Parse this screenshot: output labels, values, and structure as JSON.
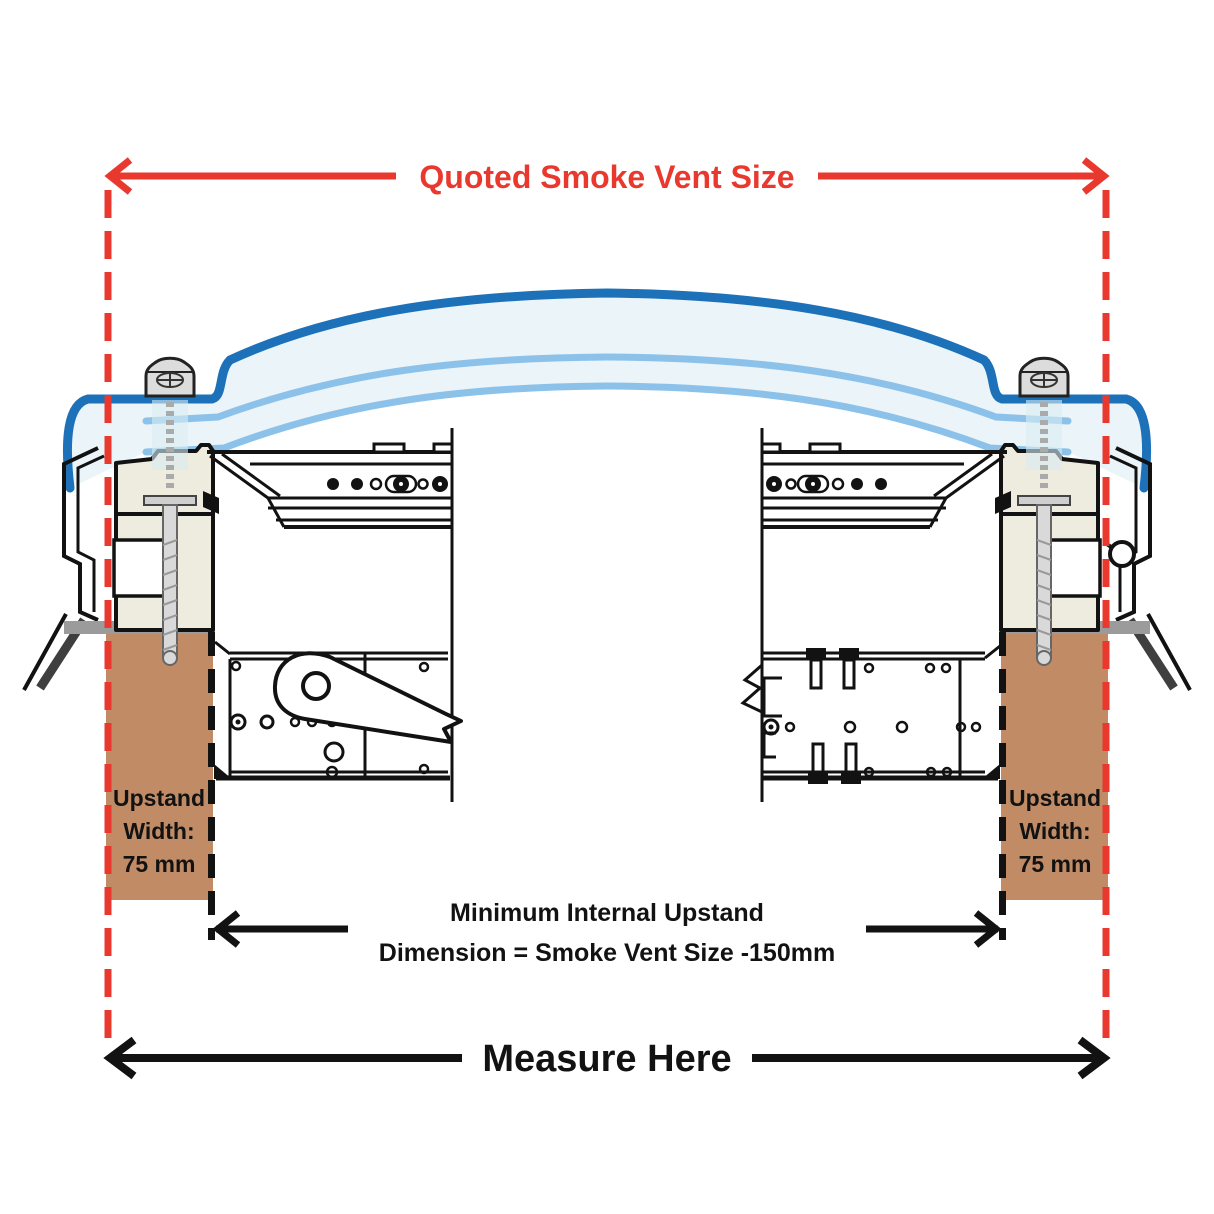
{
  "diagram": {
    "title": "Smoke vent upstand measurement cross-section",
    "annotations": {
      "top_dimension": {
        "label": "Quoted Smoke Vent Size"
      },
      "internal_dimension": {
        "line1": "Minimum Internal Upstand",
        "line2": "Dimension = Smoke Vent Size -150mm"
      },
      "upstand_left": {
        "line1": "Upstand",
        "line2": "Width:",
        "line3": "75 mm"
      },
      "upstand_right": {
        "line1": "Upstand",
        "line2": "Width:",
        "line3": "75 mm"
      },
      "bottom_dimension": {
        "label": "Measure Here"
      }
    }
  },
  "colors": {
    "dimension_red": "#e9392f",
    "line_black": "#121212",
    "dome_outer_blue": "#1d71b8",
    "dome_inner_blue": "#8cc2ea",
    "dome_fill": "#eaf4f9",
    "frame_cream": "#edecdf",
    "upstand_brown": "#c08b65",
    "capping_grey": "#9b9b9b",
    "roof_grey": "#3f3f3f",
    "screw_grey": "#d9d9d9"
  }
}
